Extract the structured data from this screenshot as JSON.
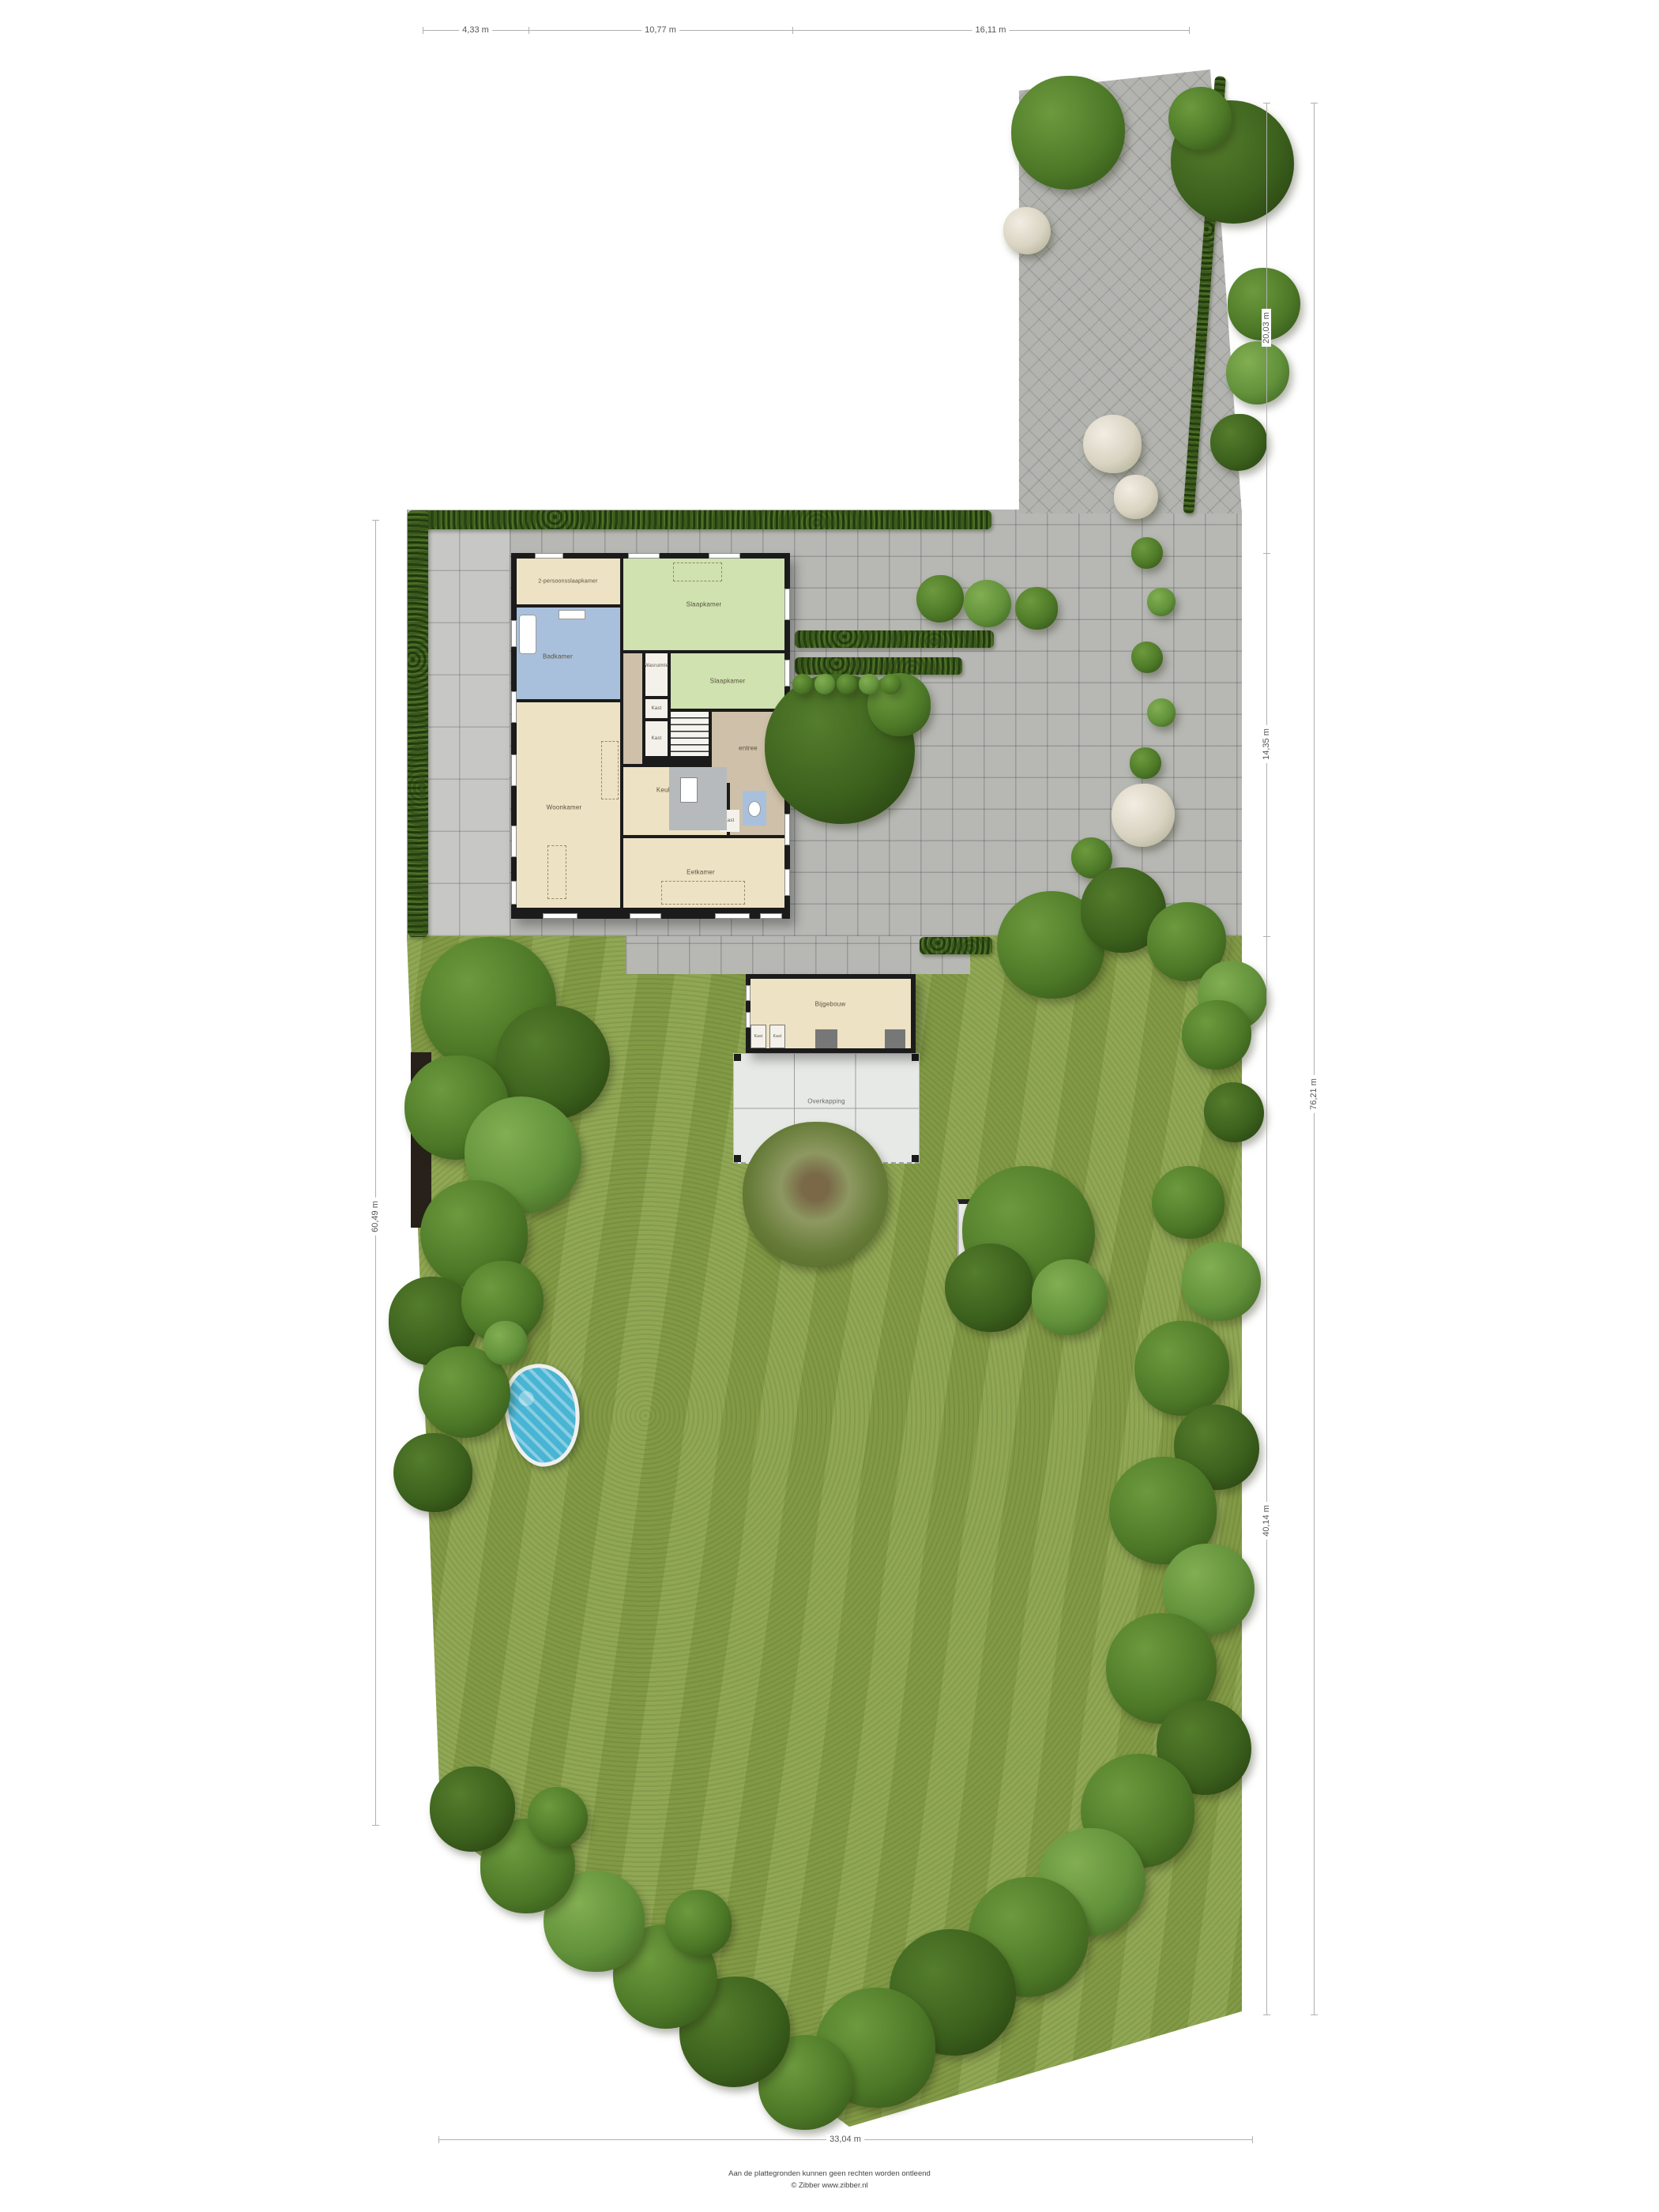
{
  "dimensions": {
    "top": [
      "4,33 m",
      "10,77 m",
      "16,11 m"
    ],
    "right_segments": [
      "20,03 m",
      "14,35 m",
      "40,14 m"
    ],
    "right_total": "76,21 m",
    "left": "60,49 m",
    "bottom": "33,04 m"
  },
  "rooms": {
    "master_bedroom": "2-persoonsslaapkamer",
    "bedroom": "Slaapkamer",
    "bathroom": "Badkamer",
    "laundry": "Wasruimte",
    "closet": "Kast",
    "living_room": "Woonkamer",
    "kitchen": "Keuken",
    "entry": "entree",
    "dining_room": "Eetkamer",
    "outbuilding": "Bijgebouw",
    "canopy": "Overkapping",
    "garden_house": "tuinhuis"
  },
  "footer": {
    "disclaimer": "Aan de plattegronden kunnen geen rechten worden ontleend",
    "credit": "© Zibber www.zibber.nl"
  },
  "palette": {
    "grass": "#8aa24b",
    "paver_yard": "#b7b8b4",
    "terrace": "#c7c7c5",
    "driveway": "#b3b4b0",
    "hedge": "#3c5a1e",
    "wall": "#1b1b1b",
    "floor_beige": "#ede2c4",
    "floor_green": "#cfe2af",
    "floor_blue": "#a9c0dc",
    "floor_tan": "#cec0a9",
    "floor_gray": "#b7babc",
    "floor_white": "#f4f1ea",
    "canopy": "#e7e9e7",
    "shed": "#ebebe9",
    "pool_water": "#49b4d3",
    "shadow_wall": "#27211a"
  }
}
